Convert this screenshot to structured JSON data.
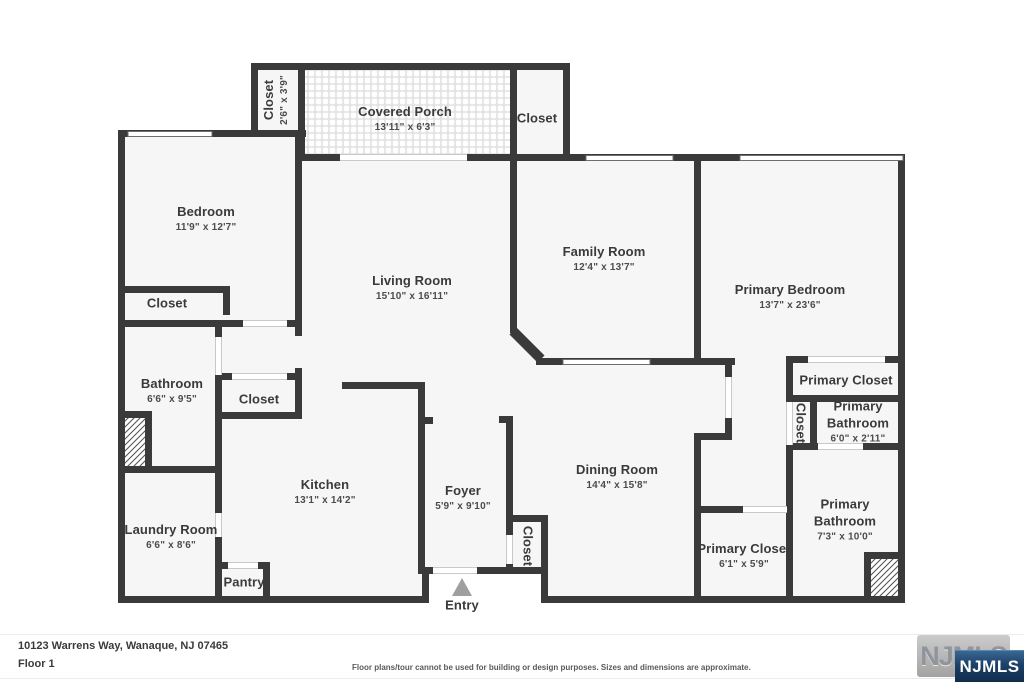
{
  "plan": {
    "rooms": {
      "bedroom": {
        "name": "Bedroom",
        "dims": "11'9\" x 12'7\""
      },
      "closet_tl": {
        "name": "Closet",
        "dims": "2'6\" x 3'9\""
      },
      "covered_porch": {
        "name": "Covered Porch",
        "dims": "13'11\" x 6'3\""
      },
      "closet_tr": {
        "name": "Closet"
      },
      "living_room": {
        "name": "Living Room",
        "dims": "15'10\" x 16'11\""
      },
      "family_room": {
        "name": "Family Room",
        "dims": "12'4\" x 13'7\""
      },
      "primary_bedroom": {
        "name": "Primary Bedroom",
        "dims": "13'7\" x 23'6\""
      },
      "closet_bedroom": {
        "name": "Closet"
      },
      "bathroom": {
        "name": "Bathroom",
        "dims": "6'6\" x 9'5\""
      },
      "closet_hall_left": {
        "name": "Closet"
      },
      "laundry_room": {
        "name": "Laundry Room",
        "dims": "6'6\" x 8'6\""
      },
      "kitchen": {
        "name": "Kitchen",
        "dims": "13'1\" x 14'2\""
      },
      "pantry": {
        "name": "Pantry"
      },
      "foyer": {
        "name": "Foyer",
        "dims": "5'9\" x 9'10\""
      },
      "closet_foyer": {
        "name": "Closet"
      },
      "dining_room": {
        "name": "Dining Room",
        "dims": "14'4\" x 15'8\""
      },
      "primary_closet_upper": {
        "name": "Primary Closet"
      },
      "closet_primary_hall": {
        "name": "Closet"
      },
      "primary_bathroom_small": {
        "name": "Primary Bathroom",
        "dims": "6'0\" x 2'11\""
      },
      "primary_bathroom_large": {
        "name": "Primary Bathroom",
        "dims": "7'3\" x 10'0\""
      },
      "primary_closet_lower": {
        "name": "Primary Closet",
        "dims": "6'1\" x 5'9\""
      }
    },
    "entry_label": "Entry"
  },
  "footer": {
    "address": "10123 Warrens Way, Wanaque, NJ 07465",
    "floor": "Floor 1",
    "disclaimer": "Floor plans/tour cannot be used for building or design purposes. Sizes and dimensions are approximate.",
    "logo_text": "NJMLS"
  },
  "colors": {
    "wall": "#3a3a3a",
    "room_fill": "#f6f6f6",
    "logo_navy": "#1b3f66"
  }
}
